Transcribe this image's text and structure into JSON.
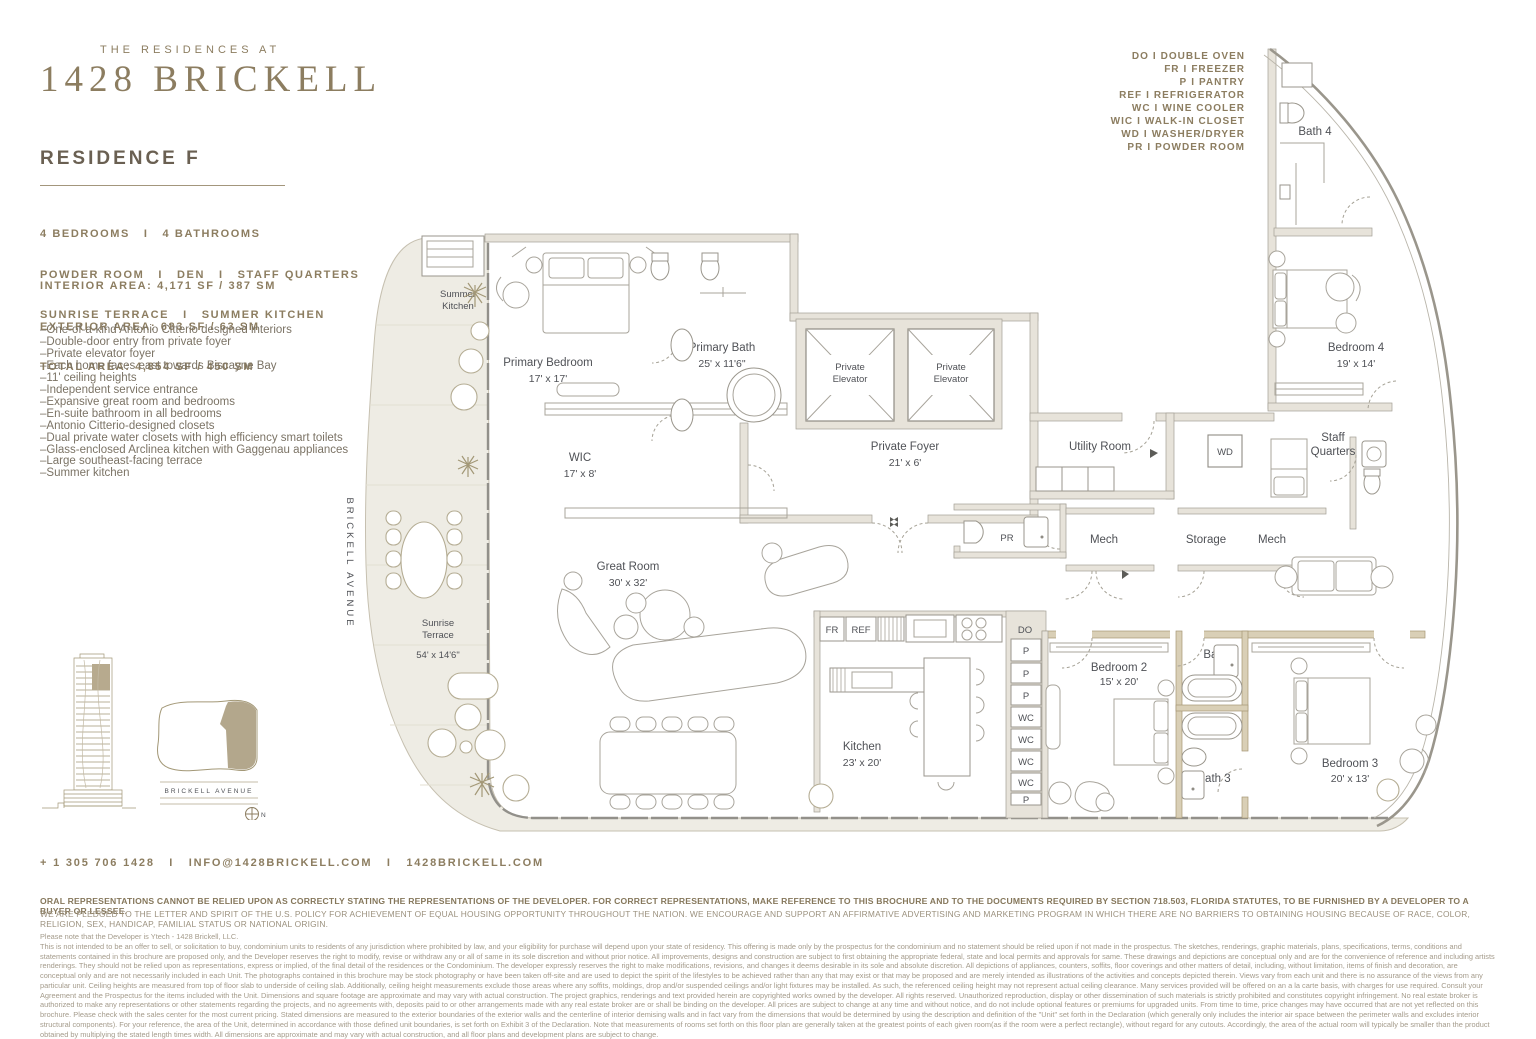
{
  "brand": {
    "pre": "THE RESIDENCES AT",
    "name": "1428 BRICKELL"
  },
  "residence": {
    "title": "RESIDENCE F",
    "program": [
      "4 BEDROOMS   I   4 BATHROOMS",
      "POWDER ROOM   I   DEN   I   STAFF QUARTERS",
      "SUNRISE TERRACE   I   SUMMER KITCHEN"
    ],
    "areas": [
      "INTERIOR AREA: 4,171 SF / 387 SM",
      "EXTERIOR AREA: 683 SF / 63 SM",
      "TOTAL AREA: 4,854 SF / 450 SM"
    ],
    "features": [
      "–One-of-a-kind Antonio Citterio designed interiors",
      "–Double-door entry from private foyer",
      "–Private elevator foyer",
      "–Each home faces east towards Biscayne Bay",
      "–11' ceiling heights",
      "–Independent service entrance",
      "–Expansive great room and bedrooms",
      "–En-suite bathroom in all bedrooms",
      "–Antonio Citterio-designed closets",
      "–Dual private water closets with high efficiency smart toilets",
      "–Glass-enclosed Arclinea kitchen with Gaggenau appliances",
      "–Large southeast-facing terrace",
      "–Summer kitchen"
    ]
  },
  "legend": {
    "sep": "I",
    "items": [
      {
        "abbr": "DO",
        "label": "DOUBLE OVEN"
      },
      {
        "abbr": "FR",
        "label": "FREEZER"
      },
      {
        "abbr": "P",
        "label": "PANTRY"
      },
      {
        "abbr": "REF",
        "label": "REFRIGERATOR"
      },
      {
        "abbr": "WC",
        "label": "WINE COOLER"
      },
      {
        "abbr": "WIC",
        "label": "WALK-IN CLOSET"
      },
      {
        "abbr": "WD",
        "label": "WASHER/DRYER"
      },
      {
        "abbr": "PR",
        "label": "POWDER ROOM"
      }
    ]
  },
  "plan": {
    "street": "BRICKELL AVENUE",
    "rooms": {
      "summer_kitchen_1": "Summer",
      "summer_kitchen_2": "Kitchen",
      "primary_bedroom": "Primary Bedroom",
      "primary_bedroom_dims": "17' x 17'",
      "primary_bath": "Primary Bath",
      "primary_bath_dims": "25' x 11'6\"",
      "wic": "WIC",
      "wic_dims": "17' x 8'",
      "private_elevator_1": "Private",
      "private_elevator_2": "Elevator",
      "private_foyer": "Private Foyer",
      "private_foyer_dims": "21' x 6'",
      "utility": "Utility Room",
      "wd": "WD",
      "staff_1": "Staff",
      "staff_2": "Quarters",
      "bath4": "Bath 4",
      "bedroom4": "Bedroom 4",
      "bedroom4_dims": "19' x 14'",
      "mech": "Mech",
      "storage": "Storage",
      "den": "Den",
      "pr": "PR",
      "great_room": "Great Room",
      "great_room_dims": "30' x 32'",
      "sunrise_1": "Sunrise",
      "sunrise_2": "Terrace",
      "sunrise_dims": "54' x 14'6\"",
      "kitchen": "Kitchen",
      "kitchen_dims": "23' x 20'",
      "fr": "FR",
      "ref": "REF",
      "do": "DO",
      "p": "P",
      "wc": "WC",
      "bedroom2": "Bedroom 2",
      "bedroom2_dims": "15' x 20'",
      "bath2": "Bath 2",
      "bath3": "Bath 3",
      "bedroom3": "Bedroom 3",
      "bedroom3_dims": "20' x 13'"
    }
  },
  "keyplan": {
    "street": "BRICKELL AVENUE",
    "north": "N"
  },
  "contact": {
    "line": "+ 1 305 706 1428   I   INFO@1428BRICKELL.COM   I   1428BRICKELL.COM"
  },
  "disclaimer": {
    "line1": "ORAL REPRESENTATIONS CANNOT BE RELIED UPON AS CORRECTLY STATING THE REPRESENTATIONS OF THE DEVELOPER. FOR CORRECT REPRESENTATIONS, MAKE REFERENCE TO THIS BROCHURE AND TO THE DOCUMENTS REQUIRED BY SECTION 718.503, FLORIDA STATUTES, TO BE FURNISHED BY A DEVELOPER TO A BUYER OR LESSEE.",
    "line2": "WE ARE PLEDGED TO THE LETTER AND SPIRIT OF THE U.S. POLICY FOR ACHIEVEMENT OF EQUAL HOUSING OPPORTUNITY THROUGHOUT THE NATION. WE ENCOURAGE AND SUPPORT AN AFFIRMATIVE ADVERTISING AND MARKETING PROGRAM IN WHICH THERE ARE NO BARRIERS TO OBTAINING HOUSING BECAUSE OF RACE, COLOR, RELIGION, SEX, HANDICAP, FAMILIAL STATUS OR NATIONAL ORIGIN.",
    "intro": "Please note that the Developer is Ytech - 1428 Brickell, LLC.",
    "body": "This is not intended to be an offer to sell, or solicitation to buy, condominium units to residents of any jurisdiction where prohibited by law, and your eligibility for purchase will depend upon your state of residency. This offering is made only by the prospectus for the condominium and no statement should be relied upon if not made in the prospectus. The sketches, renderings, graphic materials, plans, specifications, terms, conditions and statements contained in this brochure are proposed only, and the Developer reserves the right to modify, revise or withdraw any or all of same in its sole discretion and without prior notice. All improvements, designs and construction are subject to first obtaining the appropriate federal, state and local permits and approvals for same. These drawings and depictions are conceptual only and are for the convenience of reference and including artists renderings. They should not be relied upon as representations, express or implied, of the final detail of the residences or the Condominium. The developer expressly reserves the right to make modifications, revisions, and changes it deems desirable in its sole and absolute discretion. All depictions of appliances, counters, soffits, floor coverings and other matters of detail, including, without limitation, items of finish and decoration, are conceptual only and are not necessarily included in each Unit. The photographs contained in this brochure may be stock photography or have been taken off-site and are used to depict the spirit of the lifestyles to be achieved rather than any that may exist or that may be proposed and are merely intended as illustrations of the activities and concepts depicted therein. Views vary from each unit and there is no assurance of the views from any particular unit. Ceiling heights are measured from top of floor slab to underside of ceiling slab. Additionally, ceiling height measurements exclude those areas where any soffits, moldings, drop and/or suspended ceilings and/or light fixtures may be installed. As such, the referenced ceiling height may not represent actual ceiling clearance. Many services provided will be offered on an a la carte basis, with charges for use required. Consult your Agreement and the Prospectus for the items included with the Unit. Dimensions and square footage are approximate and may vary with actual construction. The project graphics, renderings and text provided herein are copyrighted works owned by the developer. All rights reserved. Unauthorized reproduction, display or other dissemination of such materials is strictly prohibited and constitutes copyright infringement. No real estate broker is authorized to make any representations or other statements regarding the projects, and no agreements with, deposits paid to or other arrangements made with any real estate broker are or shall be binding on the developer. All prices are subject to change at any time and without notice, and do not include optional features or premiums for upgraded units. From time to time, price changes may have occurred that are not yet reflected on this brochure. Please check with the sales center for the most current pricing. Stated dimensions are measured to the exterior boundaries of the exterior walls and the centerline of interior demising walls and in fact vary from the dimensions that would be determined by using the description and definition of the \"Unit\" set forth in the Declaration (which generally only includes the interior air space between the perimeter walls and excludes interior structural components). For your reference, the area of the Unit, determined in accordance with those defined unit boundaries, is set forth on Exhibit 3 of the Declaration. Note that measurements of rooms set forth on this floor plan are generally taken at the greatest points of each given room(as if the room were a perfect rectangle), without regard for any cutouts. Accordingly, the area of the actual room will typically be smaller than the product obtained by multiplying the stated length times width. All dimensions are approximate and may vary with actual construction, and all floor plans and development plans are subject to change."
  }
}
